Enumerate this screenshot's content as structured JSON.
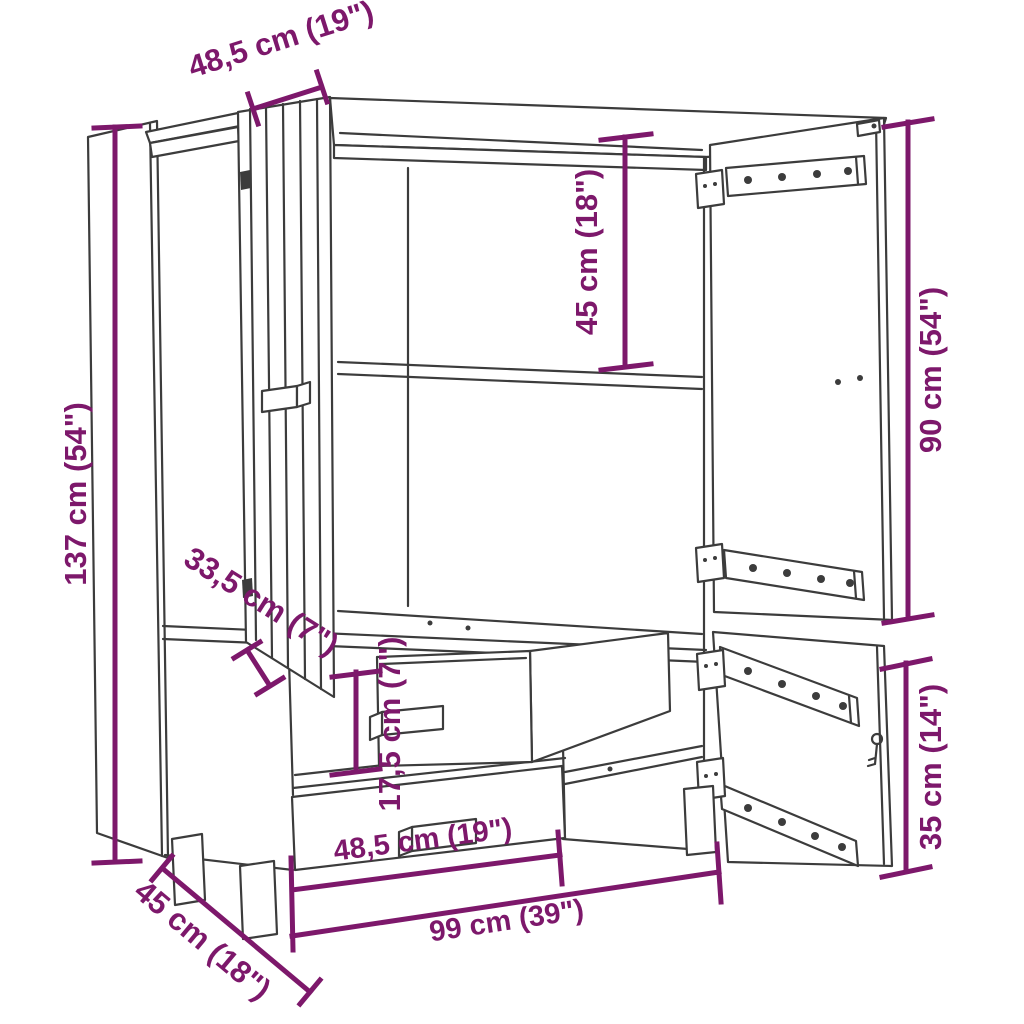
{
  "colors": {
    "background": "#ffffff",
    "line_art": "#3c3c3c",
    "dimension": "#7d186b"
  },
  "dimensions": {
    "door_width_top": "48,5 cm (19\")",
    "inner_height": "45 cm (18\")",
    "right_door_height": "90 cm (54\")",
    "total_height": "137 cm (54\")",
    "door_open_depth": "33,5 cm (7\")",
    "drawer_height": "17,5 cm (7\")",
    "drawer_width": "48,5 cm (19\")",
    "total_width": "99 cm (39\")",
    "depth": "45 cm (18\")"
  }
}
